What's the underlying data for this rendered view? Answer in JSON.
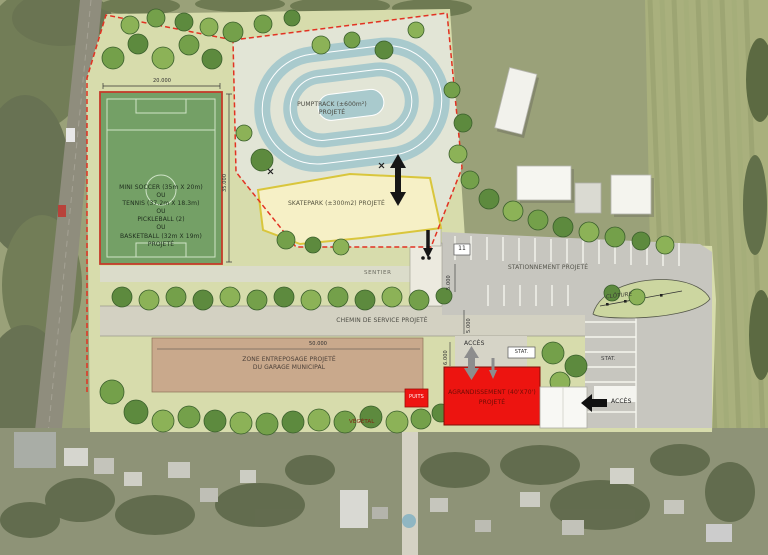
{
  "plan": {
    "field": {
      "label": "MINI SOCCER (35m X 20m)\nOU\nTENNIS (37.2m X 18.3m)\nOU\nPICKLEBALL (2)\nOU\nBASKETBALL (32m X 19m)\nPROJETÉ",
      "turf_color": "#74a066",
      "border_color": "#c43b2a"
    },
    "pumptrack": {
      "label": "PUMPTRACK (±600m²)\nPROJETÉ",
      "track_color": "#a9cacd"
    },
    "skatepark": {
      "label": "SKATEPARK (±300m2) PROJETÉ",
      "fill": "#f6f0c6",
      "edge": "#d9c63c"
    },
    "paths": {
      "sentier": "SENTIER"
    },
    "parking": {
      "label": "STATIONNEMENT PROJETÉ",
      "stall_count": "11",
      "stat_top": "STAT.",
      "stat_right": "STAT.",
      "acces_top": "ACCÈS",
      "acces_east": "ACCÈS",
      "cloture": "CLÔTURE",
      "asphalt_color": "#c7c6bf"
    },
    "service_road": {
      "label": "CHEMIN DE SERVICE PROJETÉ"
    },
    "storage": {
      "label": "ZONE ENTREPOSAGE PROJETÉ\nDU GARAGE MUNICIPAL",
      "fill": "#c9a98c"
    },
    "building": {
      "label": "AGRANDISSEMENT (40'X70')\nPROJETÉ",
      "fill": "#ed1410"
    },
    "well": {
      "label": "PUITS"
    },
    "vegetal": {
      "label": "VÉGÉTAL"
    },
    "dims": {
      "field_width": "20.000",
      "field_height": "35.000",
      "storage_width": "50.000",
      "path_width": "5.000",
      "road_width": "5.000",
      "acces_width": "6.000"
    },
    "boundary_color": "#e23222",
    "park_color": "#d7dcac"
  }
}
